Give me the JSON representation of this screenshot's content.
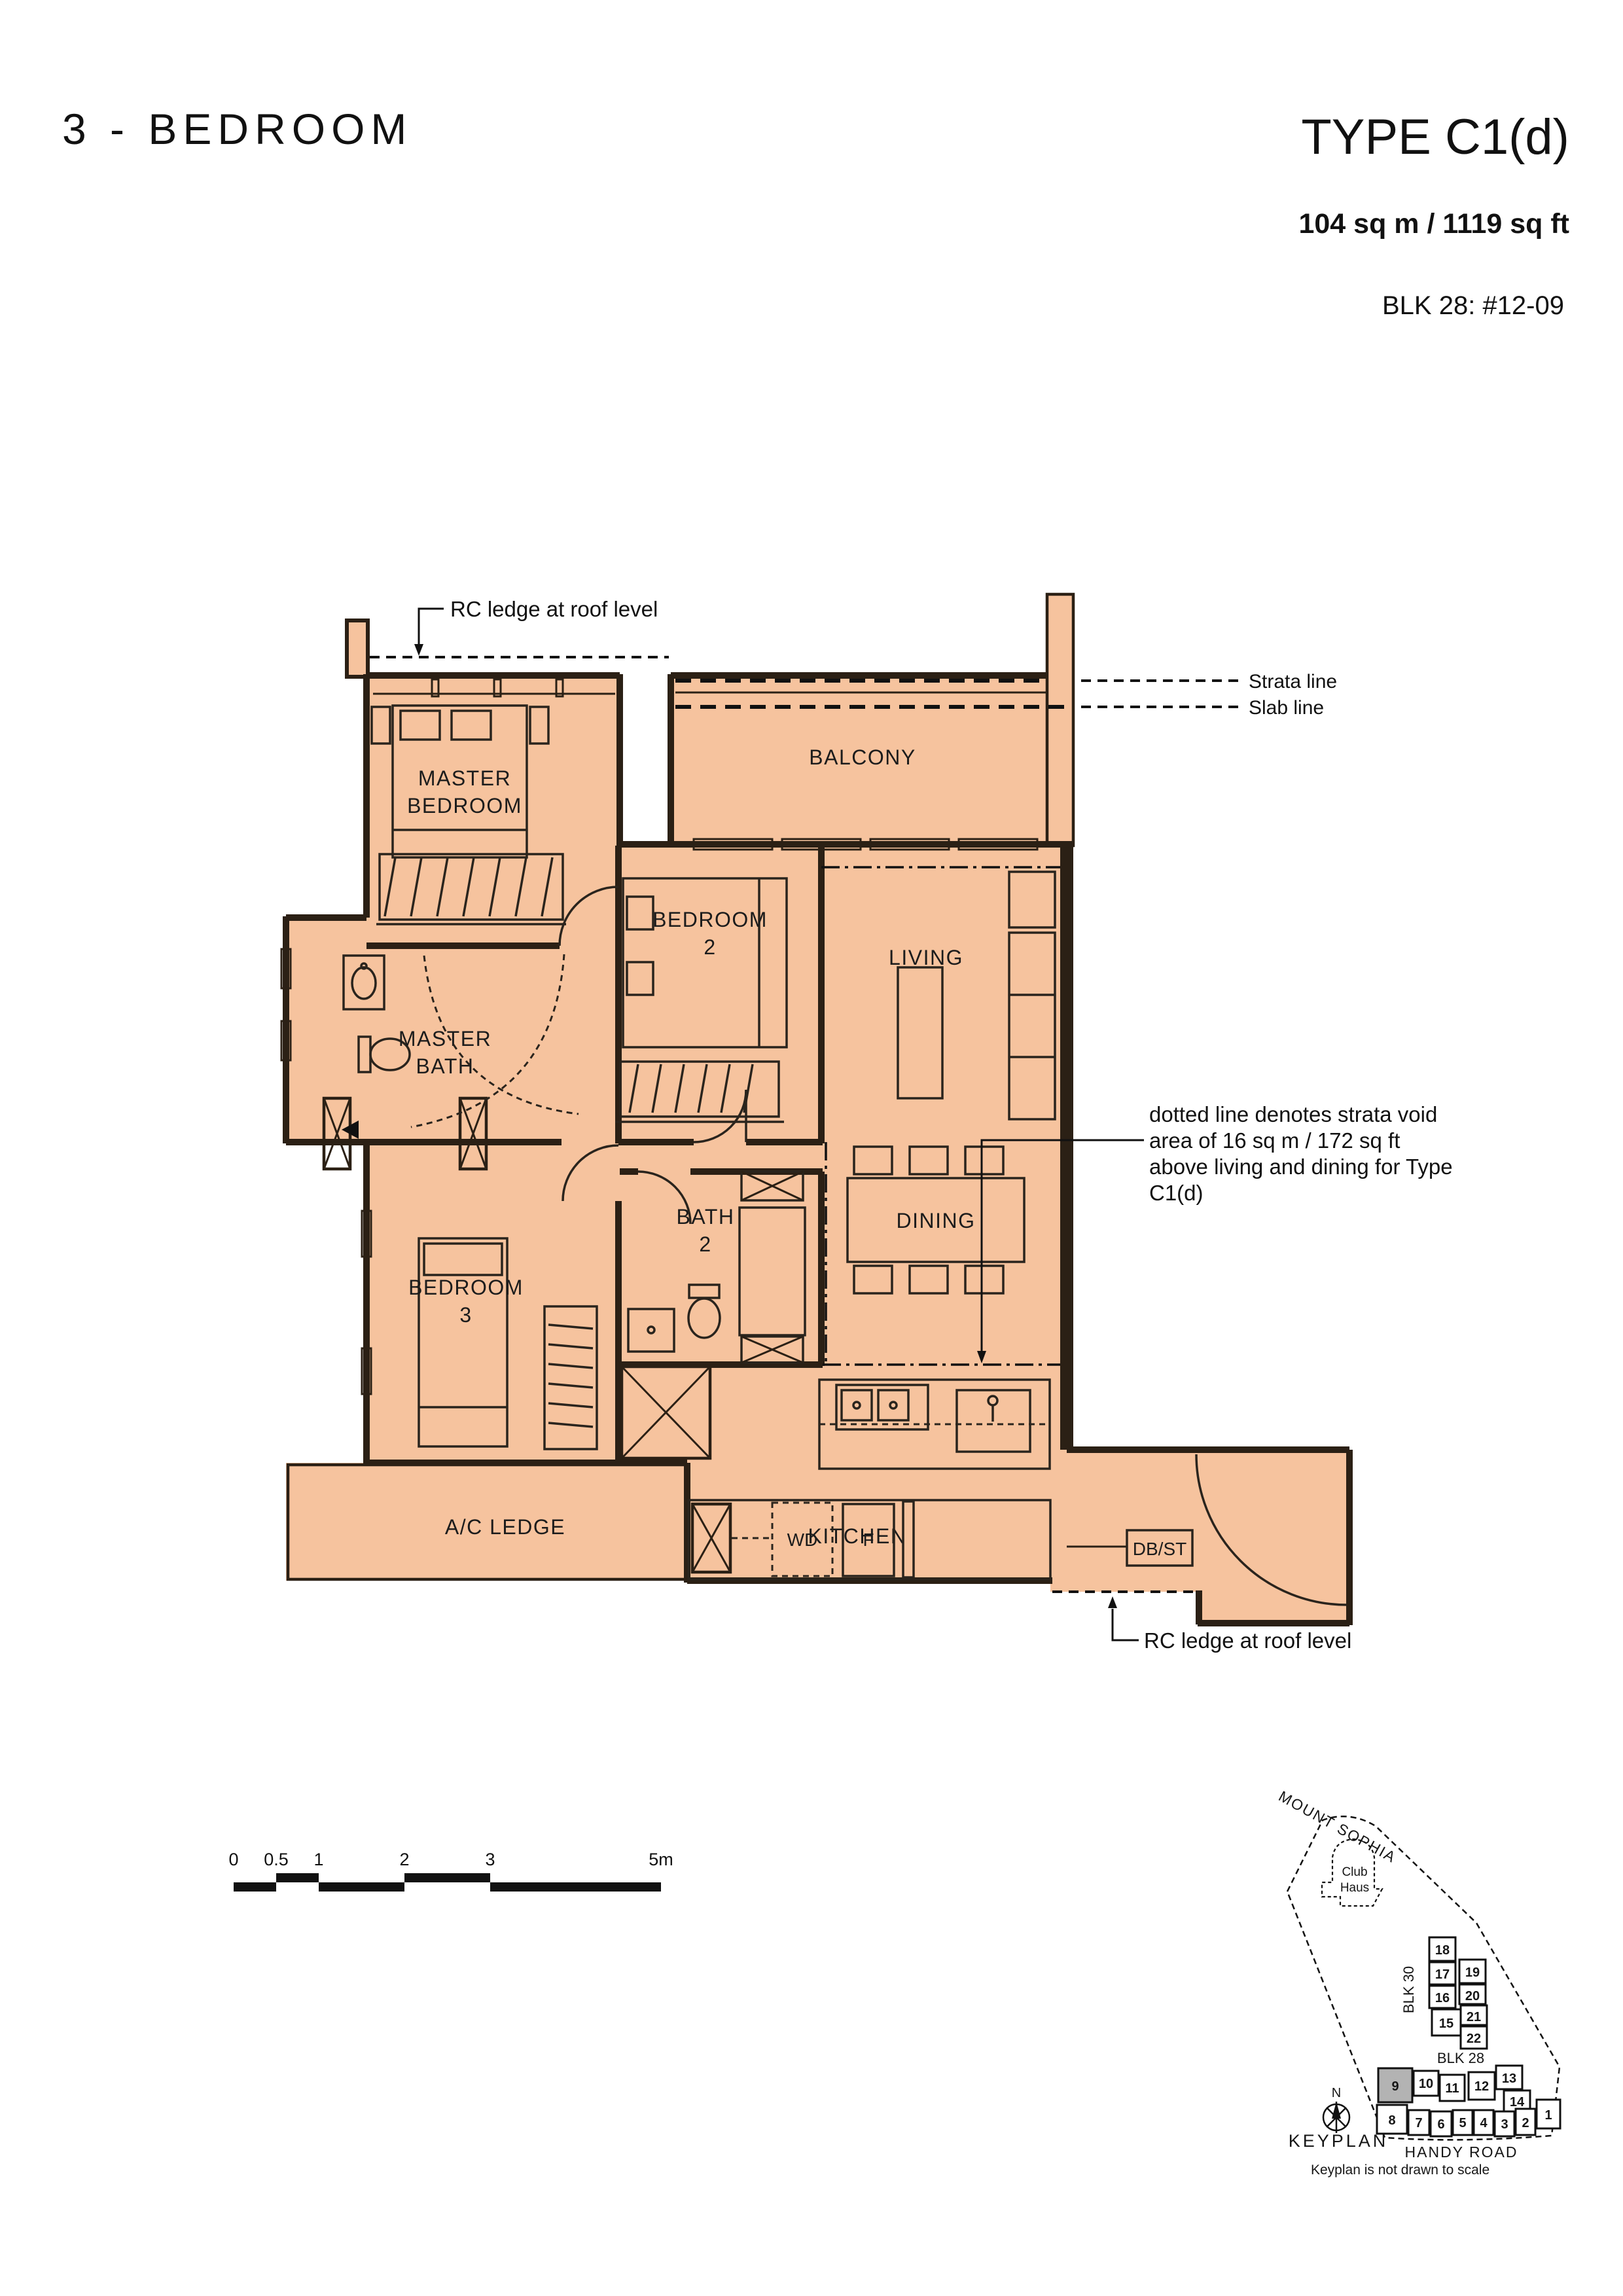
{
  "header": {
    "title": "3 - BEDROOM",
    "type": "TYPE C1(d)",
    "area": "104 sq m / 1119 sq ft",
    "unit": "BLK 28: #12-09"
  },
  "plan": {
    "rooms": {
      "master_bedroom_l1": "MASTER",
      "master_bedroom_l2": "BEDROOM",
      "balcony": "BALCONY",
      "bedroom2_l1": "BEDROOM",
      "bedroom2_l2": "2",
      "living": "LIVING",
      "master_bath_l1": "MASTER",
      "master_bath_l2": "BATH",
      "bath2_l1": "BATH",
      "bath2_l2": "2",
      "dining": "DINING",
      "bedroom3_l1": "BEDROOM",
      "bedroom3_l2": "3",
      "ac_ledge": "A/C LEDGE",
      "kitchen": "KITCHEN",
      "wd": "WD",
      "f": "F",
      "dbst": "DB/ST"
    },
    "annotations": {
      "rc_ledge_top": "RC ledge at roof level",
      "strata_line": "Strata line",
      "slab_line": "Slab line",
      "strata_void_l1": "dotted line denotes strata void",
      "strata_void_l2": "area of 16 sq m / 172 sq ft",
      "strata_void_l3": "above living and dining for Type",
      "strata_void_l4": "C1(d)",
      "rc_ledge_bottom": "RC ledge at roof level"
    }
  },
  "scalebar": {
    "labels": [
      "0",
      "0.5",
      "1",
      "2",
      "3",
      "5m"
    ]
  },
  "keyplan": {
    "road_top": "MOUNT SOPHIA",
    "club_l1": "Club",
    "club_l2": "Haus",
    "blk30": "BLK 30",
    "blk28": "BLK 28",
    "compass_n": "N",
    "title": "KEYPLAN",
    "road_bottom": "HANDY ROAD",
    "note": "Keyplan is not drawn to scale",
    "units": [
      "1",
      "2",
      "3",
      "4",
      "5",
      "6",
      "7",
      "8",
      "9",
      "10",
      "11",
      "12",
      "13",
      "14",
      "15",
      "16",
      "17",
      "18",
      "19",
      "20",
      "21",
      "22"
    ]
  },
  "colors": {
    "plan_fill": "#f6c39e",
    "wall": "#2b2015",
    "highlight": "#b3b3b3"
  }
}
